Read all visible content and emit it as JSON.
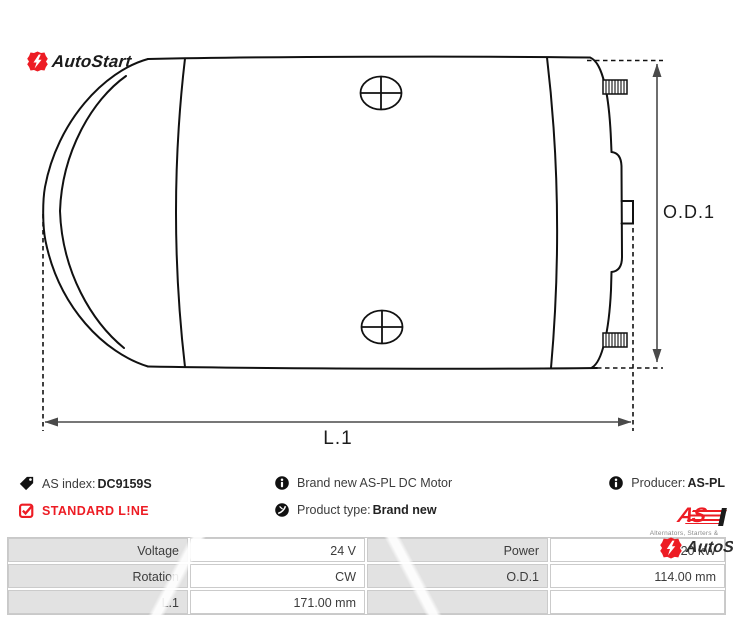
{
  "colors": {
    "brand_red": "#ed1c24",
    "table_label_bg": "#e2e2e2",
    "table_border": "#cbcbcb",
    "line_color": "#111111"
  },
  "brand": {
    "autostart_logo_text": "AutoStart",
    "autostart_watermark_text": "AutoStart"
  },
  "drawing": {
    "od1_label": "O.D.1",
    "l1_label": "L.1"
  },
  "info": {
    "as_index": {
      "label": "AS index:",
      "value": "DC9159S"
    },
    "standard_line": "STANDARD L!NE",
    "description": "Brand new AS-PL DC Motor",
    "product_type": {
      "label": "Product type:",
      "value": "Brand new"
    },
    "producer": {
      "label": "Producer:",
      "value": "AS-PL"
    },
    "aspl_logo": {
      "text": "AS",
      "caption": "Alternators, Starters & Parts"
    }
  },
  "spec_table": {
    "rows": [
      {
        "c1_label": "Voltage",
        "c1_value": "24 V",
        "c2_label": "Power",
        "c2_value": "2.20 kW"
      },
      {
        "c1_label": "Rotation",
        "c1_value": "CW",
        "c2_label": "O.D.1",
        "c2_value": "114.00 mm"
      },
      {
        "c1_label": "L.1",
        "c1_value": "171.00 mm",
        "c2_label": "",
        "c2_value": ""
      }
    ]
  }
}
